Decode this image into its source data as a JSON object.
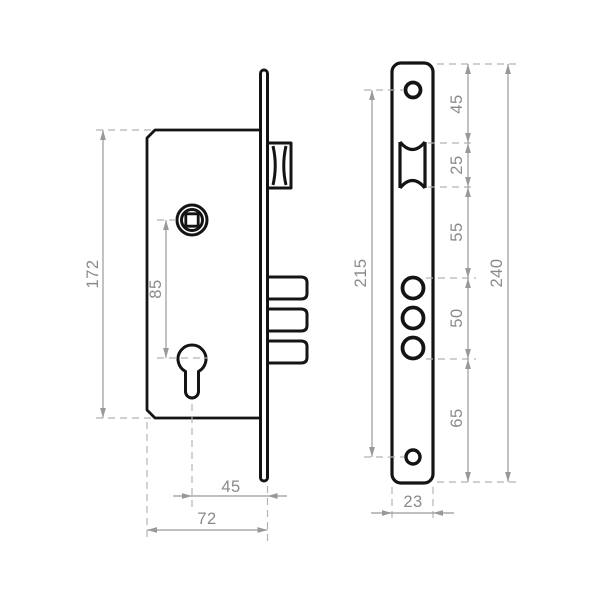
{
  "page": {
    "background": "#ffffff"
  },
  "colors": {
    "outline": "#141414",
    "dimension_line": "#999999",
    "extension_line": "#b3b3b3",
    "label_text": "#8a8a8a"
  },
  "side_view": {
    "dims": {
      "body_height": "172",
      "follower_to_cylinder": "85",
      "cylinder_to_faceplate": "45",
      "body_depth": "72"
    }
  },
  "front_view": {
    "dims": {
      "screw_hole_span": "215",
      "top_to_latch": "45",
      "latch_cutout_height": "25",
      "latch_to_bolt_holes": "55",
      "bolt_holes_span": "50",
      "bolt_holes_to_bottom": "65",
      "faceplate_height": "240",
      "faceplate_width": "23"
    }
  }
}
